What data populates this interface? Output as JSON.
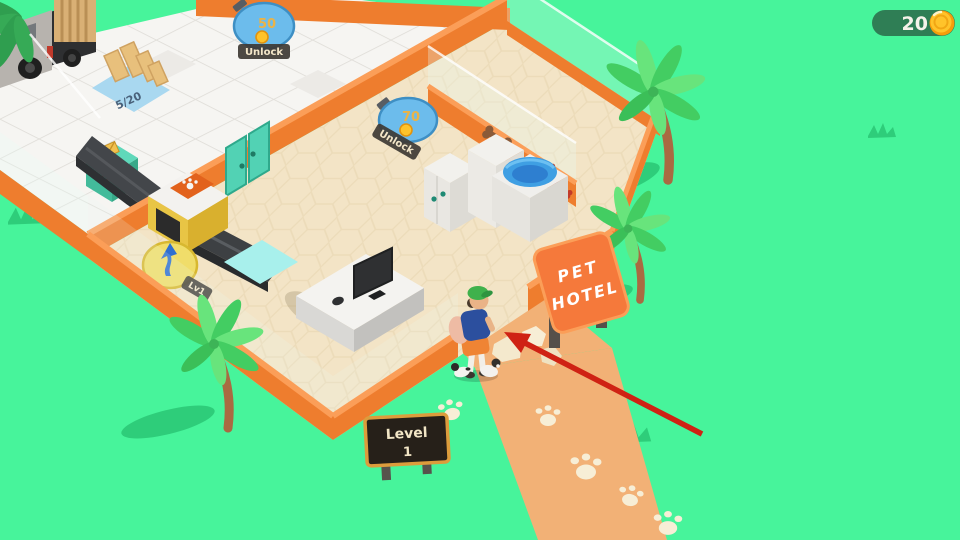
{
  "hud": {
    "coin_count": "20"
  },
  "world": {
    "unlock_back": {
      "price": "50",
      "label": "Unlock"
    },
    "unlock_kennel": {
      "price": "70",
      "label": "Unlock"
    },
    "supply_counter": "5/20",
    "mail_counter": "0/8",
    "scanner_level": "Lv1",
    "hotel_sign": {
      "line1": "PET",
      "line2": "HOTEL"
    },
    "level_sign": {
      "label": "Level",
      "value": "1"
    }
  },
  "colors": {
    "grass": "#47f49b",
    "grass_dark": "#2ecd7a",
    "wall_orange": "#ee7d2e",
    "wall_orange_light": "#fb9e58",
    "lobby_floor": "#f3e4c6",
    "room_floor": "#f6f5f2",
    "path": "#f2b176",
    "stone": "#f7eed6",
    "teal": "#52d2b4",
    "hud_pill": "#2f7e55",
    "coin_gold": "#ffc32a",
    "unlock_blue": "#6cbcec",
    "arrow_red": "#cf2214",
    "sign_orange": "#f5793b"
  }
}
